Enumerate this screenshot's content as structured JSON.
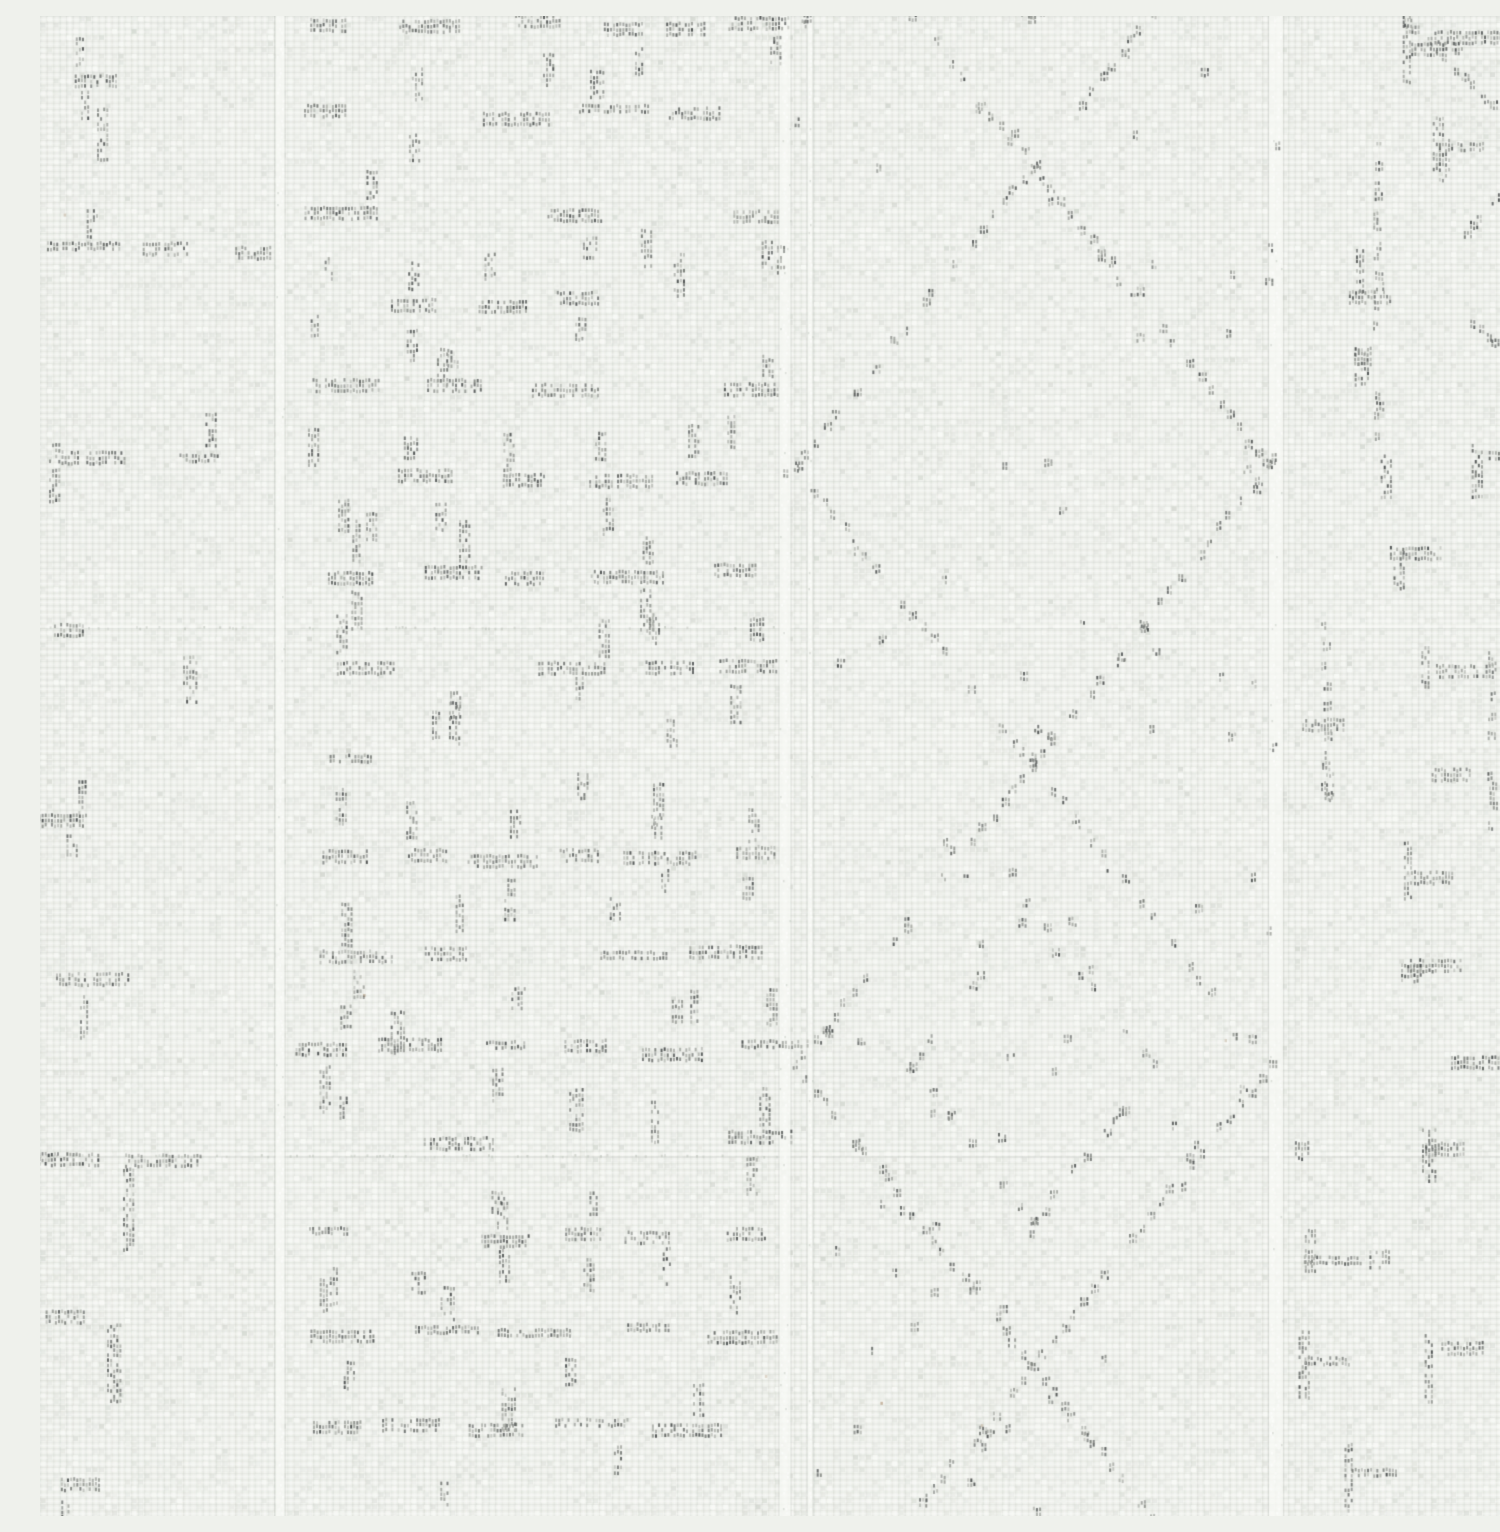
{
  "image": {
    "kind": "photograph",
    "subject": "white woven fabric swatch",
    "alt_text": "Close-up photograph of off-white plain-weave fabric with faint gray stitched patterns: a dense dashed grid band on the left, a diamond lattice band on the right, and pale vertical seam ridges"
  },
  "palette": {
    "base": "#eff1ec",
    "thread_shadow": "#bcc1b9",
    "thread_highlight": "#fcfdfa",
    "cell_light": "#fafbf8",
    "cell_mid": "#d6dad3",
    "cell_dark": "#c4c9c1",
    "seam_light": "#f8faf6",
    "seam_edge": "#aab0a8",
    "warm_fleck": "#a88c6c",
    "stitch_tones": [
      [
        166,
        169,
        163
      ],
      [
        141,
        144,
        139
      ],
      [
        114,
        118,
        113
      ],
      [
        88,
        92,
        90
      ],
      [
        64,
        68,
        68
      ]
    ]
  },
  "texture": {
    "width": 1500,
    "height": 1500,
    "seed": 20240601,
    "weave": {
      "cell_w": 6.5,
      "cell_h": 6.2,
      "noise_cells": 30000,
      "warm_flecks": 7
    },
    "vertical_seams": [
      {
        "x": 240,
        "w": 9
      },
      {
        "x": 745,
        "w": 11
      },
      {
        "x": 770,
        "w": 5
      },
      {
        "x": 1236,
        "w": 14
      }
    ],
    "horizontal_seams": [
      {
        "y": 612
      },
      {
        "y": 1140
      }
    ],
    "regions": {
      "left_band": {
        "x0": 0,
        "x1": 232,
        "row_ys": [
          62,
          235,
          440,
          612,
          800,
          965,
          1140,
          1300,
          1470
        ],
        "extra_vbars": [
          {
            "x": 62,
            "y": 92,
            "h": 55
          },
          {
            "x": 88,
            "y": 1152,
            "h": 85
          },
          {
            "x": 72,
            "y": 1308,
            "h": 78
          },
          {
            "x": 148,
            "y": 640,
            "h": 50
          },
          {
            "x": 14,
            "y": 428,
            "h": 60
          }
        ]
      },
      "grid_band": {
        "x0": 252,
        "x1": 738,
        "row_y0": 8,
        "row_y1": 1495,
        "row_step_min": 82,
        "row_step_max": 100
      },
      "diamond_band": {
        "x0": 750,
        "x1": 1240,
        "center_x": 993,
        "center_ys": [
          -150,
          450,
          1050,
          1650
        ],
        "half_w": 237,
        "half_h": 300,
        "speck_spacing": 16,
        "scatter_specks": 60
      },
      "right_band": {
        "x0": 1252,
        "x1": 1496,
        "row_y0": 20,
        "row_y1": 1490,
        "row_step_min": 80,
        "row_step_max": 115,
        "dotted_vlines": [
          {
            "x": 1338,
            "y0": 130,
            "y1": 430
          },
          {
            "x": 1286,
            "y0": 600,
            "y1": 790
          },
          {
            "x": 1452,
            "y0": 640,
            "y1": 830
          }
        ],
        "diag_chains": [
          {
            "x": 1368,
            "y": 6,
            "dx": 7,
            "dy": 7,
            "n": 13
          },
          {
            "x": 1496,
            "y": 148,
            "dx": -7,
            "dy": 7,
            "n": 11
          },
          {
            "x": 1428,
            "y": 300,
            "dx": 7,
            "dy": 7,
            "n": 9
          }
        ]
      }
    }
  }
}
